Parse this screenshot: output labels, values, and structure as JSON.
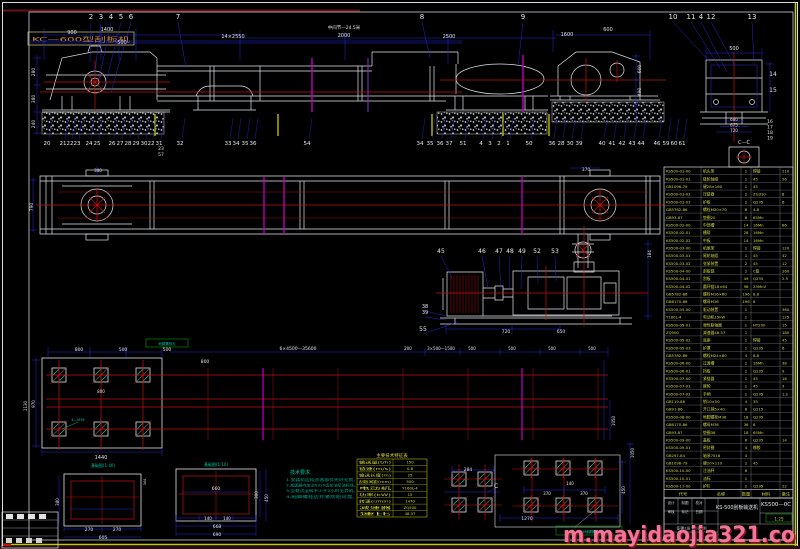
{
  "corner_label": "KC—600型刮板机",
  "watermark": "m.mayidaojia321.co",
  "colors": {
    "line_white": "#dfe3e8",
    "dim_blue": "#2a2ae0",
    "center_red": "#c41010",
    "magenta": "#c000c0",
    "accent_yellow": "#d8d840",
    "note_green": "#00c2a0",
    "watermark_pink": "#ff7fa0"
  },
  "labels": [
    [
      "900",
      72,
      34,
      5
    ],
    [
      "1400",
      107,
      31,
      5
    ],
    [
      "500",
      122,
      44,
      5
    ],
    [
      "14×2550",
      233,
      38,
      5
    ],
    [
      "中间节—24.5米",
      344,
      29,
      4.5
    ],
    [
      "2000",
      344,
      37,
      5
    ],
    [
      "2500",
      449,
      38,
      5
    ],
    [
      "1600",
      567,
      36,
      5
    ],
    [
      "600",
      608,
      31,
      5
    ],
    [
      "500",
      734,
      50,
      5
    ],
    [
      "280",
      35,
      72,
      4.5,
      "w",
      1
    ],
    [
      "380",
      35,
      99,
      4.5,
      "w",
      1
    ],
    [
      "240",
      35,
      124,
      4.5,
      "w",
      1
    ],
    [
      "600",
      641,
      69,
      4.5,
      "w",
      1
    ],
    [
      "490",
      641,
      92,
      4.5,
      "w",
      1
    ],
    [
      "600",
      734,
      121,
      4
    ],
    [
      "675",
      734,
      126.5,
      4
    ],
    [
      "720",
      734,
      132,
      4
    ],
    [
      "14",
      773,
      76,
      6
    ],
    [
      "15",
      773,
      92,
      6
    ],
    [
      "16",
      770,
      123,
      4.5
    ],
    [
      "17",
      770,
      128.5,
      4.5
    ],
    [
      "18",
      770,
      134,
      4.5
    ],
    [
      "19",
      770,
      139.5,
      4.5
    ],
    [
      "C—C",
      744,
      144,
      5
    ],
    [
      "23",
      161,
      150,
      4.5
    ],
    [
      "57",
      161,
      156,
      4.5
    ],
    [
      "790",
      33,
      207,
      4.5,
      "w",
      1
    ],
    [
      "300",
      98,
      172,
      4
    ],
    [
      "370",
      586,
      171,
      4.5
    ],
    [
      "184",
      651,
      254,
      4,
      "w",
      1
    ],
    [
      "720",
      506,
      333,
      4.5
    ],
    [
      "650",
      561,
      333,
      4.5
    ],
    [
      "800",
      79,
      351,
      4.5
    ],
    [
      "500",
      123,
      351,
      4.5
    ],
    [
      "500",
      167,
      351,
      4.5
    ],
    [
      "6×4500—35600",
      298,
      350,
      4.5
    ],
    [
      "200",
      408,
      350,
      4
    ],
    [
      "3×500—1500",
      441,
      350,
      4
    ],
    [
      "500",
      472,
      350,
      4
    ],
    [
      "500",
      512,
      350,
      4
    ],
    [
      "500",
      552,
      350,
      4
    ],
    [
      "500",
      592,
      350,
      4
    ],
    [
      "800",
      205,
      363,
      4.5
    ],
    [
      "800",
      101,
      393,
      4
    ],
    [
      "970",
      35,
      404,
      4,
      "w",
      1
    ],
    [
      "1130",
      27,
      406,
      4,
      "w",
      1
    ],
    [
      "1440",
      101,
      459,
      5
    ],
    [
      "1050",
      615,
      421,
      4,
      "w",
      1
    ],
    [
      "4—M36",
      78,
      421,
      3.5,
      "g"
    ],
    [
      "地脚螺栓孔",
      167,
      345,
      3.5,
      "g"
    ],
    [
      "基础图(1:40)",
      103,
      467,
      4,
      "g"
    ],
    [
      "基础图(1:10)",
      216,
      466,
      4,
      "g"
    ],
    [
      "270",
      89,
      531,
      4.5
    ],
    [
      "270",
      117,
      531,
      4.5
    ],
    [
      "605",
      103,
      539,
      4.5
    ],
    [
      "380",
      59,
      502,
      4,
      "w",
      1
    ],
    [
      "344",
      146,
      482,
      3.5,
      "w",
      1
    ],
    [
      "660",
      216,
      490,
      4.5
    ],
    [
      "140",
      208,
      520,
      4
    ],
    [
      "140",
      227,
      520,
      4
    ],
    [
      "668",
      217,
      528,
      4.5
    ],
    [
      "690",
      217,
      536,
      4.5
    ],
    [
      "300",
      258,
      495,
      4,
      "w",
      1
    ],
    [
      "450",
      268,
      498,
      4,
      "w",
      1
    ],
    [
      "284",
      468,
      471,
      4.5
    ],
    [
      "C",
      496,
      488,
      6
    ],
    [
      "140",
      570,
      485,
      4
    ],
    [
      "370",
      547,
      495,
      4
    ],
    [
      "370",
      584,
      495,
      4
    ],
    [
      "1270",
      527,
      520,
      4.5
    ],
    [
      "450",
      625,
      490,
      4,
      "w",
      1
    ],
    [
      "1050",
      634,
      453,
      4,
      "w",
      1
    ],
    [
      "18—M36地脚螺栓M400",
      589,
      533,
      3.5,
      "g"
    ],
    [
      "主要技术特征表",
      392,
      457,
      4.5,
      "y"
    ]
  ],
  "callouts": [
    [
      "2",
      91,
      19,
      90,
      62,
      7
    ],
    [
      "3",
      101,
      19,
      95,
      72,
      7
    ],
    [
      "4",
      111,
      19,
      99,
      80,
      7
    ],
    [
      "5",
      121,
      19,
      105,
      86,
      7
    ],
    [
      "6",
      131,
      19,
      111,
      92,
      7
    ],
    [
      "7",
      178,
      19,
      186,
      68,
      7
    ],
    [
      "8",
      422,
      19,
      430,
      58,
      7
    ],
    [
      "9",
      523,
      19,
      518,
      66,
      7
    ],
    [
      "10",
      673,
      19,
      710,
      62,
      7
    ],
    [
      "11",
      691,
      19,
      720,
      68,
      7
    ],
    [
      "4",
      701,
      19,
      727,
      72,
      7
    ],
    [
      "12",
      711,
      19,
      735,
      66,
      7
    ],
    [
      "13",
      752,
      19,
      754,
      62,
      7
    ],
    [
      "45",
      441,
      253,
      452,
      278,
      6
    ],
    [
      "46",
      482,
      253,
      488,
      288,
      6
    ],
    [
      "47",
      499,
      253,
      501,
      289,
      6
    ],
    [
      "48",
      510,
      253,
      509,
      290,
      6
    ],
    [
      "49",
      522,
      253,
      521,
      289,
      6
    ],
    [
      "52",
      537,
      253,
      538,
      283,
      6
    ],
    [
      "53",
      555,
      253,
      556,
      281,
      6
    ],
    [
      "38",
      425,
      308,
      446,
      316,
      5
    ],
    [
      "39",
      425,
      314,
      446,
      320,
      5
    ],
    [
      "55",
      423,
      331,
      458,
      322,
      6
    ]
  ],
  "bottom_nums": [
    [
      "20",
      47
    ],
    [
      "21",
      63
    ],
    [
      "22",
      70
    ],
    [
      "23",
      77
    ],
    [
      "24",
      89
    ],
    [
      "25",
      97
    ],
    [
      "26",
      112
    ],
    [
      "27",
      120
    ],
    [
      "28",
      128
    ],
    [
      "29",
      136
    ],
    [
      "30",
      144
    ],
    [
      "22",
      151
    ],
    [
      "31",
      159
    ],
    [
      "32",
      180
    ],
    [
      "33",
      228
    ],
    [
      "34",
      236
    ],
    [
      "35",
      245
    ],
    [
      "36",
      253
    ],
    [
      "54",
      307
    ],
    [
      "34",
      420
    ],
    [
      "35",
      430
    ],
    [
      "36",
      440
    ],
    [
      "37",
      449
    ],
    [
      "51",
      463
    ],
    [
      "4",
      481
    ],
    [
      "3",
      490
    ],
    [
      "2",
      499
    ],
    [
      "1",
      508
    ],
    [
      "50",
      529
    ],
    [
      "36",
      552
    ],
    [
      "28",
      561
    ],
    [
      "30",
      570
    ],
    [
      "39",
      579
    ],
    [
      "40",
      602
    ],
    [
      "41",
      612
    ],
    [
      "42",
      622
    ],
    [
      "43",
      632
    ],
    [
      "44",
      641
    ],
    [
      "46",
      657
    ],
    [
      "59",
      666
    ],
    [
      "60",
      674
    ],
    [
      "61",
      682
    ]
  ],
  "bom": {
    "header": [
      "代号",
      "名称",
      "数量",
      "材料",
      "备注"
    ],
    "rows": [
      [
        "KS500-01-00",
        "机头架",
        "1",
        "焊接",
        "210"
      ],
      [
        "KS500-01-01",
        "链轮轴组",
        "1",
        "45",
        "56"
      ],
      [
        "GB1096-79",
        "键28×160",
        "1",
        "45",
        ""
      ],
      [
        "KS500-01-02",
        "压链器",
        "2",
        "ZG310",
        "8"
      ],
      [
        "KS500-01-03",
        "护板",
        "2",
        "Q235",
        "6"
      ],
      [
        "GB5782-86",
        "螺栓M20×70",
        "8",
        "4.8",
        ""
      ],
      [
        "GB93-87",
        "垫圈20",
        "8",
        "65Mn",
        ""
      ],
      [
        "KS500-02-00",
        "中部槽",
        "14",
        "16Mn",
        "86"
      ],
      [
        "KS500-02-01",
        "槽帮",
        "28",
        "16Mn",
        ""
      ],
      [
        "KS500-02-02",
        "中板",
        "14",
        "16Mn",
        ""
      ],
      [
        "KS500-03-00",
        "机尾架",
        "1",
        "焊接",
        "120"
      ],
      [
        "KS500-03-01",
        "尾轮轴组",
        "1",
        "45",
        "42"
      ],
      [
        "KS500-03-02",
        "张紧装置",
        "2",
        "45",
        "12"
      ],
      [
        "KS500-04-00",
        "刮板链",
        "2",
        "C级",
        "260"
      ],
      [
        "KS500-04-01",
        "刮板",
        "49",
        "Q235",
        "2.5"
      ],
      [
        "KS500-04-02",
        "圆环链18×64",
        "98",
        "23MnV",
        ""
      ],
      [
        "GB5782-86",
        "螺栓M16×60",
        "196",
        "8.8",
        ""
      ],
      [
        "GB6170-86",
        "螺母M16",
        "196",
        "8",
        ""
      ],
      [
        "KS500-05-00",
        "驱动装置",
        "1",
        "",
        "360"
      ],
      [
        "Y160L-4",
        "电动机15kW",
        "1",
        "",
        "125"
      ],
      [
        "KS500-05-01",
        "弹性联轴器",
        "1",
        "HT200",
        "15"
      ],
      [
        "ZQ500",
        "减速器48.57",
        "1",
        "",
        "180"
      ],
      [
        "KS500-05-02",
        "底座",
        "1",
        "焊接",
        "45"
      ],
      [
        "KS500-05-03",
        "护罩",
        "1",
        "Q235",
        "6"
      ],
      [
        "GB5782-86",
        "螺栓M24×80",
        "4",
        "8.8",
        ""
      ],
      [
        "KS500-06-00",
        "过渡槽",
        "2",
        "16Mn",
        "38"
      ],
      [
        "KS500-06-01",
        "挡板",
        "2",
        "Q235",
        "9"
      ],
      [
        "KS500-07-00",
        "紧链器",
        "1",
        "45",
        "16"
      ],
      [
        "KS500-07-01",
        "棘轮",
        "1",
        "45",
        "3"
      ],
      [
        "KS500-07-02",
        "手柄",
        "1",
        "Q235",
        "1.2"
      ],
      [
        "GB119-86",
        "销10×50",
        "4",
        "35",
        ""
      ],
      [
        "GB91-86",
        "开口销5×40",
        "8",
        "Q215",
        ""
      ],
      [
        "KS500-08-00",
        "地脚螺栓M36",
        "18",
        "Q235",
        ""
      ],
      [
        "GB6170-86",
        "螺母M36",
        "36",
        "8",
        ""
      ],
      [
        "GB93-87",
        "垫圈36",
        "18",
        "65Mn",
        ""
      ],
      [
        "KS500-09-00",
        "盖板",
        "6",
        "Q235",
        "14"
      ],
      [
        "KS500-09-01",
        "密封圈",
        "4",
        "橡胶",
        ""
      ],
      [
        "GB297-84",
        "轴承7518",
        "4",
        "",
        ""
      ],
      [
        "GB1096-79",
        "键20×110",
        "2",
        "45",
        ""
      ],
      [
        "KS500-10-00",
        "注油杯",
        "6",
        "",
        ""
      ],
      [
        "KS500-10-01",
        "油标",
        "1",
        "",
        ""
      ],
      [
        "KS500-11-00",
        "护栏",
        "2",
        "Q235",
        "22"
      ]
    ]
  },
  "param_table": {
    "rows": [
      [
        "输送量(t/h)",
        "150"
      ],
      [
        "链速(m/s)",
        "0.8"
      ],
      [
        "输送长度(m)",
        "25"
      ],
      [
        "刮板间距(mm)",
        "500"
      ],
      [
        "电动机",
        "Y160L-4"
      ],
      [
        "功率(kW)",
        "15"
      ],
      [
        "转速(r/min)",
        "1470"
      ],
      [
        "减速器",
        "ZQ500"
      ],
      [
        "速比",
        "48.57"
      ]
    ]
  },
  "notes": {
    "title": "技术要求",
    "lines": [
      "1.安装前应检查各部件完好无损。",
      "2.减速器内加注N320齿轮油至油标线。",
      "3.空载试运转不少于2小时无异响。",
      "4.地脚螺栓应拧紧防松可靠。"
    ]
  },
  "title_block": {
    "product": "KS-500刮板输送机",
    "dwg_no": "KS500—0C",
    "scale": "1:25",
    "sheet": "共1张 第1张",
    "cells": [
      "设计",
      "制图",
      "校对",
      "审核",
      "标记",
      "日期",
      "签字",
      "比例"
    ]
  }
}
